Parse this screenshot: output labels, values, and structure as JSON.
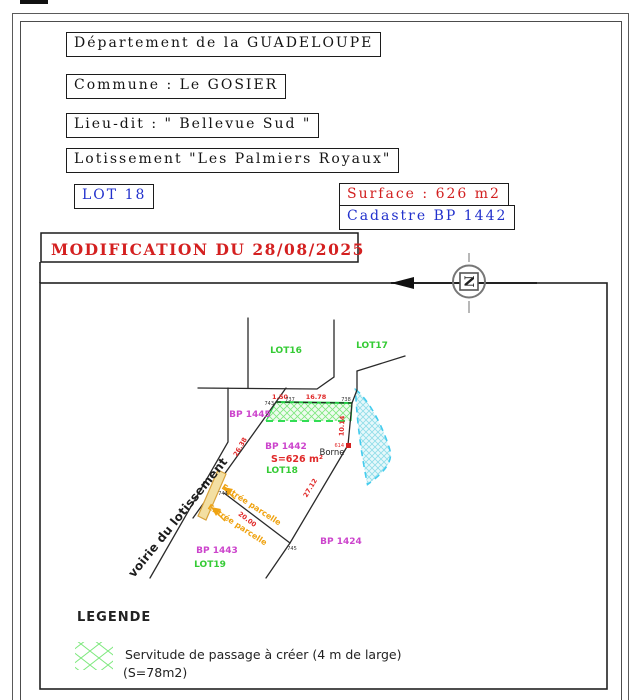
{
  "document": {
    "departement": "Département de la GUADELOUPE",
    "commune": "Commune : Le GOSIER",
    "lieu_dit": "Lieu-dit : \" Bellevue Sud \"",
    "lotissement": "Lotissement \"Les Palmiers Royaux\"",
    "lot": "LOT 18",
    "surface": "Surface : 626 m2",
    "cadastre": "Cadastre BP 1442",
    "modification": "MODIFICATION DU 28/08/2025"
  },
  "north_arrow": {
    "letter": "N"
  },
  "plan": {
    "lots": {
      "lot16": "LOT16",
      "lot17": "LOT17",
      "lot18": "LOT18",
      "lot19": "LOT19"
    },
    "parcels": {
      "bp1445": "BP 1445",
      "bp1442": "BP 1442",
      "bp1443": "BP 1443",
      "bp1424": "BP 1424"
    },
    "area_label": "S=626 m²",
    "borne_label": "Borne",
    "road_label": "voirie du lotissement",
    "entrance_label_1": "Entrée parcelle",
    "entrance_label_2": "Entrée parcelle",
    "dimensions": {
      "d_150": "1.50",
      "d_1678": "16.78",
      "d_1014": "10.14",
      "d_2638": "26.38",
      "d_2712": "27.12",
      "d_2000": "20.00"
    },
    "points": {
      "p743": "743",
      "p737": "737",
      "p738": "738",
      "p744": "744",
      "p745": "745",
      "p614": "614"
    }
  },
  "legend": {
    "title": "LEGENDE",
    "servitude_line1": "Servitude de passage à créer (4 m de large)",
    "servitude_line2": "(S=78m2)"
  },
  "colors": {
    "header_blue": "#2231cc",
    "header_red": "#d22020",
    "label_green": "#35cb35",
    "label_magenta": "#cc44cc",
    "dimension_red": "#e02828",
    "entrance_orange": "#efa312",
    "servitude_green_hatch": "#7de87d",
    "easement_cyan": "#44ccee",
    "road_strip_fill": "#f3dfa2"
  }
}
